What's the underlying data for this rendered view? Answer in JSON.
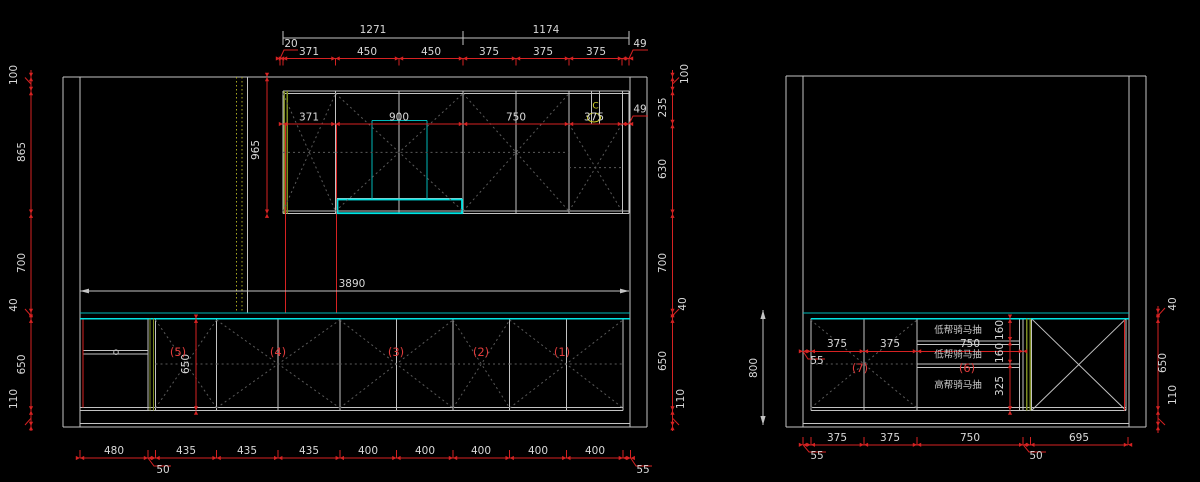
{
  "drawing": {
    "type": "kitchen-cabinet-elevation-cad",
    "background_color": "#000000",
    "colors": {
      "dimension_red": "#d62222",
      "geometry_gray": "#c3c3c3",
      "countertop_cyan": "#00e4e4",
      "panel_olive": "#7d8c21",
      "hidden_yellow": "#a8a820",
      "label_red": "#e23c3c",
      "text_gray": "#d9d9d9"
    },
    "left_elevation": {
      "overall_top_dims": [
        1271,
        1174
      ],
      "upper_cabinet_dims": [
        20,
        371,
        450,
        450,
        375,
        375,
        375,
        49
      ],
      "upper_interior_dims": [
        371,
        900,
        750,
        375,
        49
      ],
      "upper_height_dim": 965,
      "left_chain": [
        100,
        865,
        700,
        40,
        650,
        110
      ],
      "right_chain": [
        100,
        235,
        630,
        700,
        40,
        650,
        110
      ],
      "counter_length_dim": 3890,
      "base_height_dim": 650,
      "base_section_labels": [
        "(5)",
        "(4)",
        "(3)",
        "(2)",
        "(1)"
      ],
      "bottom_dims": [
        480,
        435,
        435,
        435,
        400,
        400,
        400,
        400,
        400
      ],
      "bottom_leaders": [
        50,
        55
      ],
      "symbol": "C"
    },
    "right_elevation": {
      "interior_dims": [
        375,
        375,
        750
      ],
      "interior_leader": 55,
      "section_labels": [
        "(7)",
        "(6)"
      ],
      "drawer_labels": [
        "低帮骑马抽",
        "低帮骑马抽",
        "高帮骑马抽"
      ],
      "drawer_height_dims": [
        160,
        160,
        325
      ],
      "counter_height_dim": 800,
      "right_chain": [
        40,
        650,
        110
      ],
      "bottom_dims": [
        375,
        375,
        750,
        695
      ],
      "bottom_leaders": [
        55,
        50
      ]
    }
  },
  "labels": [
    {
      "t": "1271",
      "x": 373,
      "y": 33
    },
    {
      "t": "1174",
      "x": 546,
      "y": 33
    },
    {
      "t": "20",
      "x": 291,
      "y": 47
    },
    {
      "t": "371",
      "x": 309,
      "y": 55
    },
    {
      "t": "450",
      "x": 367,
      "y": 55
    },
    {
      "t": "450",
      "x": 431,
      "y": 55
    },
    {
      "t": "375",
      "x": 489,
      "y": 55
    },
    {
      "t": "375",
      "x": 543,
      "y": 55
    },
    {
      "t": "375",
      "x": 596,
      "y": 55
    },
    {
      "t": "49",
      "x": 640,
      "y": 47
    },
    {
      "t": "371",
      "x": 309,
      "y": 120.5
    },
    {
      "t": "900",
      "x": 399,
      "y": 120.5
    },
    {
      "t": "750",
      "x": 516,
      "y": 120.5
    },
    {
      "t": "375",
      "x": 594,
      "y": 120.5
    },
    {
      "t": "49",
      "x": 640,
      "y": 112.5
    },
    {
      "t": "C",
      "x": 595.5,
      "y": 108.5,
      "c": "yellow"
    },
    {
      "t": "965",
      "x": 259,
      "y": 150,
      "r": 1
    },
    {
      "t": "100",
      "x": 17,
      "y": 75,
      "r": 1
    },
    {
      "t": "865",
      "x": 25,
      "y": 152,
      "r": 1
    },
    {
      "t": "700",
      "x": 25,
      "y": 263,
      "r": 1
    },
    {
      "t": "40",
      "x": 17,
      "y": 305,
      "r": 1
    },
    {
      "t": "650",
      "x": 25,
      "y": 364.5,
      "r": 1
    },
    {
      "t": "110",
      "x": 17,
      "y": 399,
      "r": 1
    },
    {
      "t": "100",
      "x": 688,
      "y": 74,
      "r": 1
    },
    {
      "t": "235",
      "x": 666,
      "y": 107.5,
      "r": 1
    },
    {
      "t": "630",
      "x": 666,
      "y": 169,
      "r": 1
    },
    {
      "t": "700",
      "x": 666,
      "y": 263,
      "r": 1
    },
    {
      "t": "40",
      "x": 686,
      "y": 304,
      "r": 1
    },
    {
      "t": "650",
      "x": 666,
      "y": 361,
      "r": 1
    },
    {
      "t": "110",
      "x": 684,
      "y": 399,
      "r": 1
    },
    {
      "t": "3890",
      "x": 352,
      "y": 287
    },
    {
      "t": "650",
      "x": 189,
      "y": 364,
      "r": 1
    },
    {
      "t": "(5)",
      "x": 178,
      "y": 356,
      "c": "accent"
    },
    {
      "t": "(4)",
      "x": 278,
      "y": 356,
      "c": "accent"
    },
    {
      "t": "(3)",
      "x": 396,
      "y": 356,
      "c": "accent"
    },
    {
      "t": "(2)",
      "x": 481,
      "y": 356,
      "c": "accent"
    },
    {
      "t": "(1)",
      "x": 562,
      "y": 356,
      "c": "accent"
    },
    {
      "t": "480",
      "x": 114,
      "y": 454
    },
    {
      "t": "435",
      "x": 186,
      "y": 454
    },
    {
      "t": "435",
      "x": 247,
      "y": 454
    },
    {
      "t": "435",
      "x": 309,
      "y": 454
    },
    {
      "t": "400",
      "x": 368,
      "y": 454
    },
    {
      "t": "400",
      "x": 425,
      "y": 454
    },
    {
      "t": "400",
      "x": 481,
      "y": 454
    },
    {
      "t": "400",
      "x": 538,
      "y": 454
    },
    {
      "t": "400",
      "x": 595,
      "y": 454
    },
    {
      "t": "50",
      "x": 163,
      "y": 473
    },
    {
      "t": "55",
      "x": 643,
      "y": 473
    },
    {
      "t": "375",
      "x": 837,
      "y": 347
    },
    {
      "t": "375",
      "x": 890,
      "y": 347
    },
    {
      "t": "750",
      "x": 970,
      "y": 347
    },
    {
      "t": "55",
      "x": 817,
      "y": 364
    },
    {
      "t": "(7)",
      "x": 860,
      "y": 372,
      "c": "accent"
    },
    {
      "t": "(6)",
      "x": 967,
      "y": 372,
      "c": "accent"
    },
    {
      "t": "低帮骑马抽",
      "x": 958,
      "y": 333,
      "c": "cjk"
    },
    {
      "t": "低帮骑马抽",
      "x": 958,
      "y": 357.5,
      "c": "cjk"
    },
    {
      "t": "高帮骑马抽",
      "x": 958,
      "y": 388,
      "c": "cjk"
    },
    {
      "t": "160",
      "x": 1003,
      "y": 330,
      "r": 1
    },
    {
      "t": "160",
      "x": 1003,
      "y": 353,
      "r": 1
    },
    {
      "t": "325",
      "x": 1003,
      "y": 386,
      "r": 1
    },
    {
      "t": "800",
      "x": 757,
      "y": 368,
      "r": 1
    },
    {
      "t": "40",
      "x": 1176,
      "y": 304,
      "r": 1
    },
    {
      "t": "650",
      "x": 1166,
      "y": 363,
      "r": 1
    },
    {
      "t": "110",
      "x": 1176,
      "y": 395,
      "r": 1
    },
    {
      "t": "375",
      "x": 837,
      "y": 441
    },
    {
      "t": "375",
      "x": 890,
      "y": 441
    },
    {
      "t": "750",
      "x": 970,
      "y": 441
    },
    {
      "t": "695",
      "x": 1079,
      "y": 441
    },
    {
      "t": "55",
      "x": 817,
      "y": 459
    },
    {
      "t": "50",
      "x": 1036,
      "y": 459
    }
  ]
}
